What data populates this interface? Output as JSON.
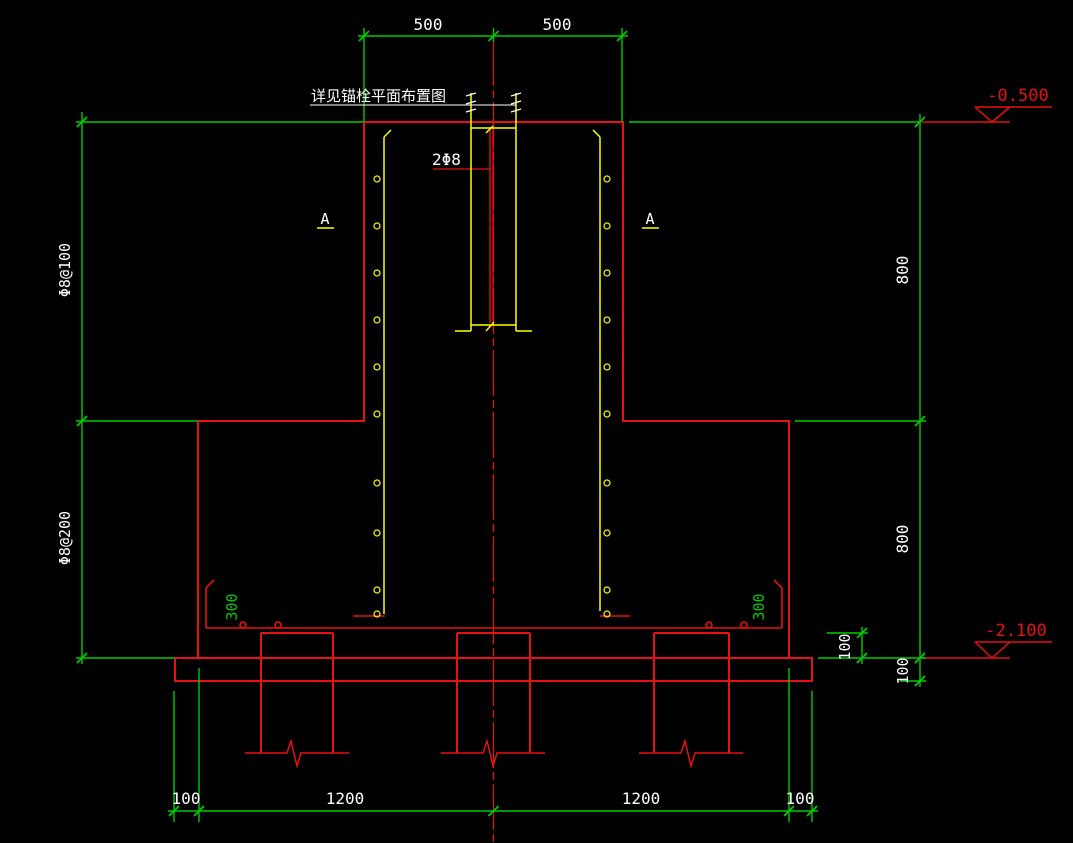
{
  "colors": {
    "background": "#000000",
    "structure_red": "#e81010",
    "dimension_green": "#00cc00",
    "rebar_yellow": "#ffff00",
    "text_white": "#ffffff"
  },
  "labels": {
    "note": "详见锚栓平面布置图",
    "bar_label": "2Φ8",
    "section_left": "A",
    "section_right": "A",
    "elev_top": "-0.500",
    "elev_bottom": "-2.100",
    "dim_top_left": "500",
    "dim_top_right": "500",
    "stirrup_upper": "Φ8@100",
    "stirrup_lower": "Φ8@200",
    "dim_right_upper": "800",
    "dim_right_lower": "800",
    "dim_pile_embed": "100",
    "dim_cushion": "100",
    "hook_left": "300",
    "hook_right": "300",
    "dim_bottom_edge_left": "100",
    "dim_bottom_span_left": "1200",
    "dim_bottom_span_right": "1200",
    "dim_bottom_edge_right": "100"
  }
}
